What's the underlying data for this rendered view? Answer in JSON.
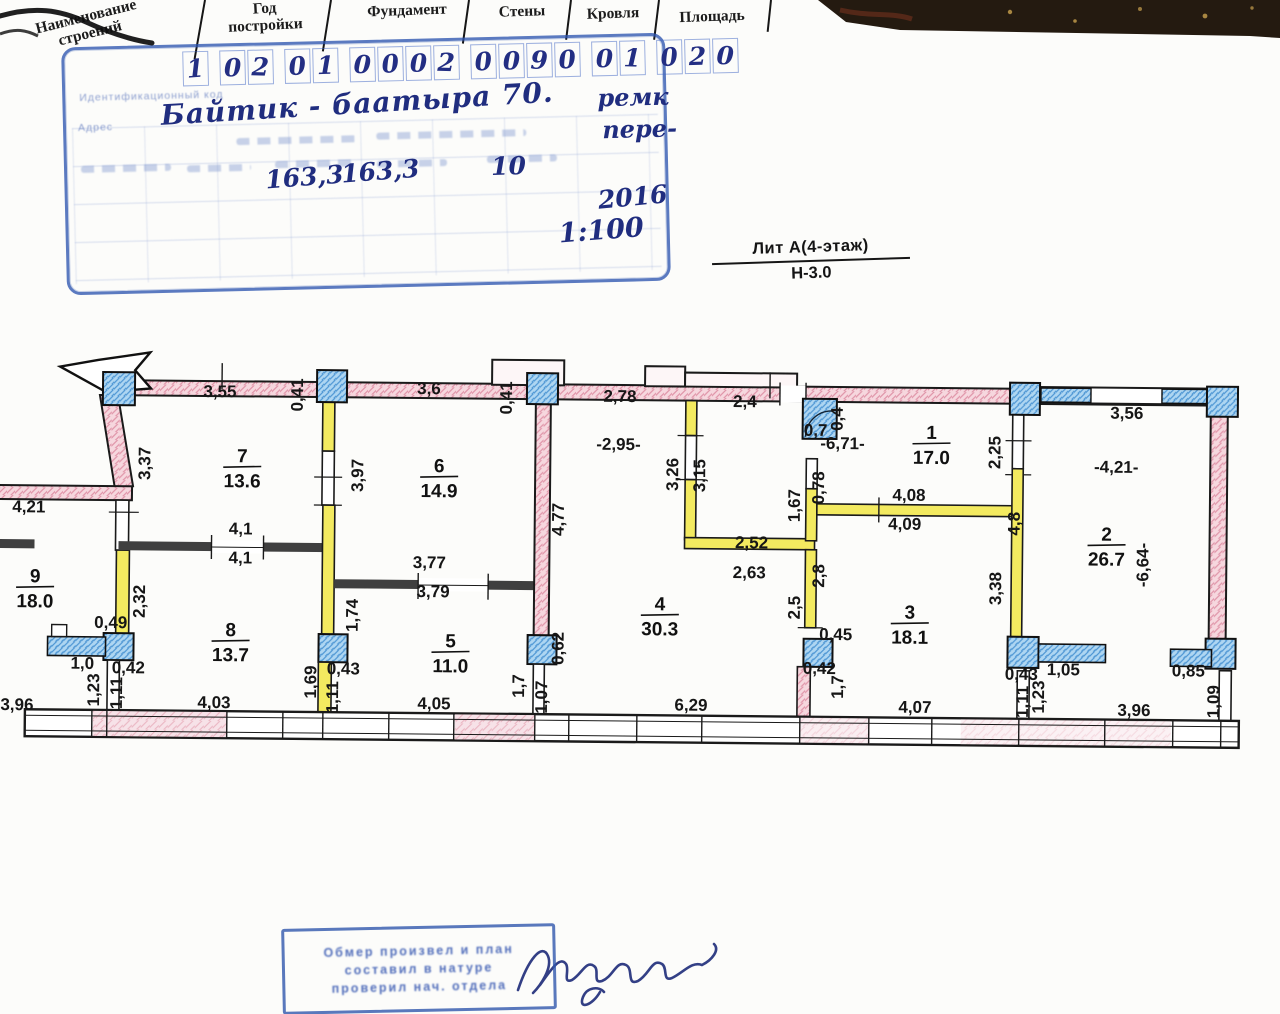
{
  "header": {
    "columns": [
      "Наименование строений",
      "Год постройки",
      "Фундамент",
      "Стены",
      "Кровля",
      "Площадь"
    ]
  },
  "stamp_top": {
    "code_digits": "1 02 01 0002 0090 01 020",
    "address": "Байтик - баатыра 70.",
    "note_line1": "ремк",
    "note_line2": "пере-",
    "area_total": "163,3",
    "area_second": "163,3",
    "value_10": "10",
    "year": "2016",
    "scale": "1:100",
    "faint_label_code": "Идентификационный код",
    "faint_label_address": "Адрес"
  },
  "litera": {
    "line1": "Лит А(4-этаж)",
    "line2": "Н-3.0"
  },
  "plan": {
    "rooms": [
      {
        "num": "9",
        "area": "18.0",
        "x": 37,
        "y": 583
      },
      {
        "num": "7",
        "area": "13.6",
        "x": 243,
        "y": 461
      },
      {
        "num": "8",
        "area": "13.7",
        "x": 233,
        "y": 635
      },
      {
        "num": "6",
        "area": "14.9",
        "x": 440,
        "y": 469
      },
      {
        "num": "5",
        "area": "11.0",
        "x": 453,
        "y": 644
      },
      {
        "num": "4",
        "area": "30.3",
        "x": 662,
        "y": 605
      },
      {
        "num": "3",
        "area": "18.1",
        "x": 912,
        "y": 611
      },
      {
        "num": "1",
        "area": "17.0",
        "x": 932,
        "y": 431
      },
      {
        "num": "2",
        "area": "26.7",
        "x": 1108,
        "y": 531
      }
    ],
    "dimensions": [
      {
        "t": "3,55",
        "x": 220,
        "y": 396,
        "r": 0
      },
      {
        "t": "0,41",
        "x": 303,
        "y": 393,
        "r": -90
      },
      {
        "t": "3,6",
        "x": 429,
        "y": 391,
        "r": 0
      },
      {
        "t": "0,41",
        "x": 512,
        "y": 394,
        "r": -90
      },
      {
        "t": "2,78",
        "x": 620,
        "y": 397,
        "r": 0
      },
      {
        "t": "2,4",
        "x": 745,
        "y": 401,
        "r": 0
      },
      {
        "t": "0,7",
        "x": 816,
        "y": 429,
        "r": 0
      },
      {
        "t": "0,4",
        "x": 843,
        "y": 412,
        "r": -90
      },
      {
        "t": "3,56",
        "x": 1127,
        "y": 409,
        "r": 0
      },
      {
        "t": "-6,71-",
        "x": 843,
        "y": 442,
        "r": 0
      },
      {
        "t": "2,25",
        "x": 1001,
        "y": 444,
        "r": -90
      },
      {
        "t": "-2,95-",
        "x": 619,
        "y": 445,
        "r": 0
      },
      {
        "t": "-4,21-",
        "x": 1117,
        "y": 463,
        "r": 0
      },
      {
        "t": "3,37",
        "x": 151,
        "y": 463,
        "r": -90
      },
      {
        "t": "4,21",
        "x": 30,
        "y": 513,
        "r": 0
      },
      {
        "t": "3,97",
        "x": 364,
        "y": 473,
        "r": -90
      },
      {
        "t": "4,1",
        "x": 242,
        "y": 533,
        "r": 0
      },
      {
        "t": "4,1",
        "x": 242,
        "y": 562,
        "r": 0
      },
      {
        "t": "3,77",
        "x": 431,
        "y": 565,
        "r": 0
      },
      {
        "t": "3,79",
        "x": 435,
        "y": 594,
        "r": 0
      },
      {
        "t": "4,77",
        "x": 565,
        "y": 515,
        "r": -90
      },
      {
        "t": "3,26",
        "x": 679,
        "y": 469,
        "r": -90
      },
      {
        "t": "3,15",
        "x": 706,
        "y": 470,
        "r": -90
      },
      {
        "t": "1,67",
        "x": 801,
        "y": 499,
        "r": -90
      },
      {
        "t": "0,78",
        "x": 825,
        "y": 481,
        "r": -90
      },
      {
        "t": "4,08",
        "x": 910,
        "y": 493,
        "r": 0
      },
      {
        "t": "4,09",
        "x": 906,
        "y": 522,
        "r": 0
      },
      {
        "t": "2,52",
        "x": 753,
        "y": 542,
        "r": 0
      },
      {
        "t": "2,63",
        "x": 751,
        "y": 572,
        "r": 0
      },
      {
        "t": "2,8",
        "x": 826,
        "y": 569,
        "r": -90
      },
      {
        "t": "2,5",
        "x": 802,
        "y": 601,
        "r": -90
      },
      {
        "t": "4,8",
        "x": 1021,
        "y": 515,
        "r": -90
      },
      {
        "t": "3,38",
        "x": 1003,
        "y": 580,
        "r": -90
      },
      {
        "t": "-6,64-",
        "x": 1150,
        "y": 555,
        "r": -90
      },
      {
        "t": "2,32",
        "x": 147,
        "y": 601,
        "r": -90
      },
      {
        "t": "1,74",
        "x": 360,
        "y": 613,
        "r": -90
      },
      {
        "t": "0,49",
        "x": 113,
        "y": 628,
        "r": 0
      },
      {
        "t": "0,45",
        "x": 838,
        "y": 633,
        "r": 0
      },
      {
        "t": "1,0",
        "x": 85,
        "y": 669,
        "r": 0
      },
      {
        "t": "0,42",
        "x": 131,
        "y": 673,
        "r": 0
      },
      {
        "t": "1,23",
        "x": 102,
        "y": 690,
        "r": -90
      },
      {
        "t": "1,11",
        "x": 125,
        "y": 693,
        "r": -90
      },
      {
        "t": "4,03",
        "x": 217,
        "y": 707,
        "r": 0
      },
      {
        "t": "1,69",
        "x": 319,
        "y": 680,
        "r": -90
      },
      {
        "t": "0,43",
        "x": 346,
        "y": 672,
        "r": 0
      },
      {
        "t": "1,11",
        "x": 341,
        "y": 695,
        "r": -90
      },
      {
        "t": "4,05",
        "x": 437,
        "y": 706,
        "r": 0
      },
      {
        "t": "1,7",
        "x": 527,
        "y": 682,
        "r": -90
      },
      {
        "t": "1,07",
        "x": 550,
        "y": 693,
        "r": -90
      },
      {
        "t": "0,62",
        "x": 566,
        "y": 644,
        "r": -90
      },
      {
        "t": "6,29",
        "x": 694,
        "y": 705,
        "r": 0
      },
      {
        "t": "0,42",
        "x": 822,
        "y": 667,
        "r": 0
      },
      {
        "t": "1,7",
        "x": 846,
        "y": 680,
        "r": -90
      },
      {
        "t": "4,07",
        "x": 918,
        "y": 705,
        "r": 0
      },
      {
        "t": "0,43",
        "x": 1024,
        "y": 671,
        "r": 0
      },
      {
        "t": "1,11",
        "x": 1031,
        "y": 693,
        "r": -90
      },
      {
        "t": "1,23",
        "x": 1047,
        "y": 688,
        "r": -90
      },
      {
        "t": "1,05",
        "x": 1066,
        "y": 666,
        "r": 0
      },
      {
        "t": "3,96",
        "x": 1137,
        "y": 706,
        "r": 0
      },
      {
        "t": "0,85",
        "x": 1191,
        "y": 666,
        "r": 0
      },
      {
        "t": "1,09",
        "x": 1222,
        "y": 691,
        "r": -90
      },
      {
        "t": "3,96",
        "x": 20,
        "y": 711,
        "r": 0
      }
    ]
  },
  "stamp_bottom": {
    "lines": [
      "Обмер произвел и план",
      "составил в натуре",
      "проверил нач. отдела"
    ]
  }
}
